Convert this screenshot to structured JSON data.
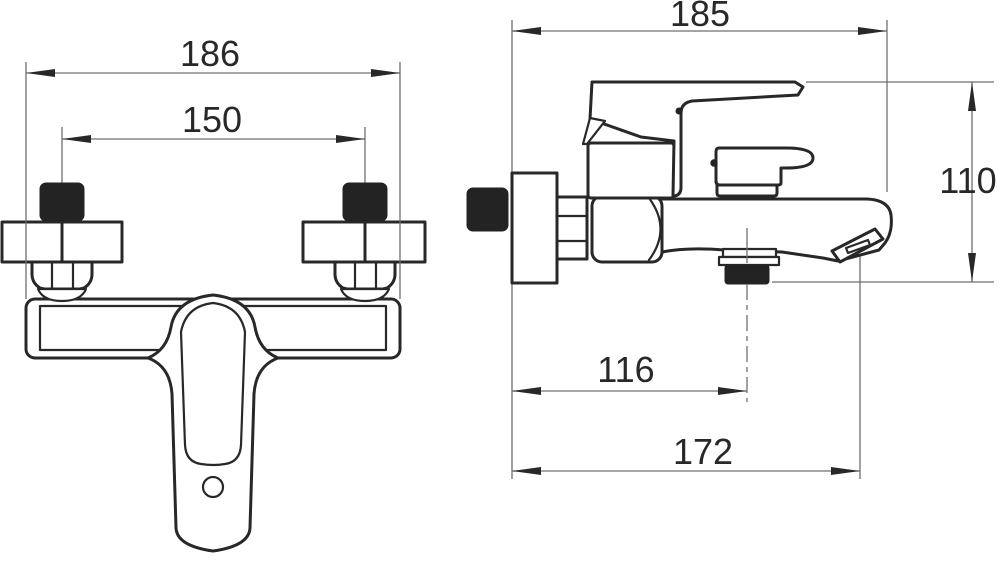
{
  "drawing": {
    "type": "technical-dimension-drawing",
    "subject": "wall-mounted bath shower mixer faucet, front and side elevation views",
    "units": "mm",
    "front_view": {
      "overall_width": "186",
      "connection_spacing": "150"
    },
    "side_view": {
      "overall_depth": "185",
      "overall_height": "110",
      "shower_outlet_offset": "116",
      "spout_reach": "172"
    },
    "colors": {
      "outline": "#282828",
      "thin_line": "#6f6f6f",
      "background": "#ffffff"
    }
  }
}
